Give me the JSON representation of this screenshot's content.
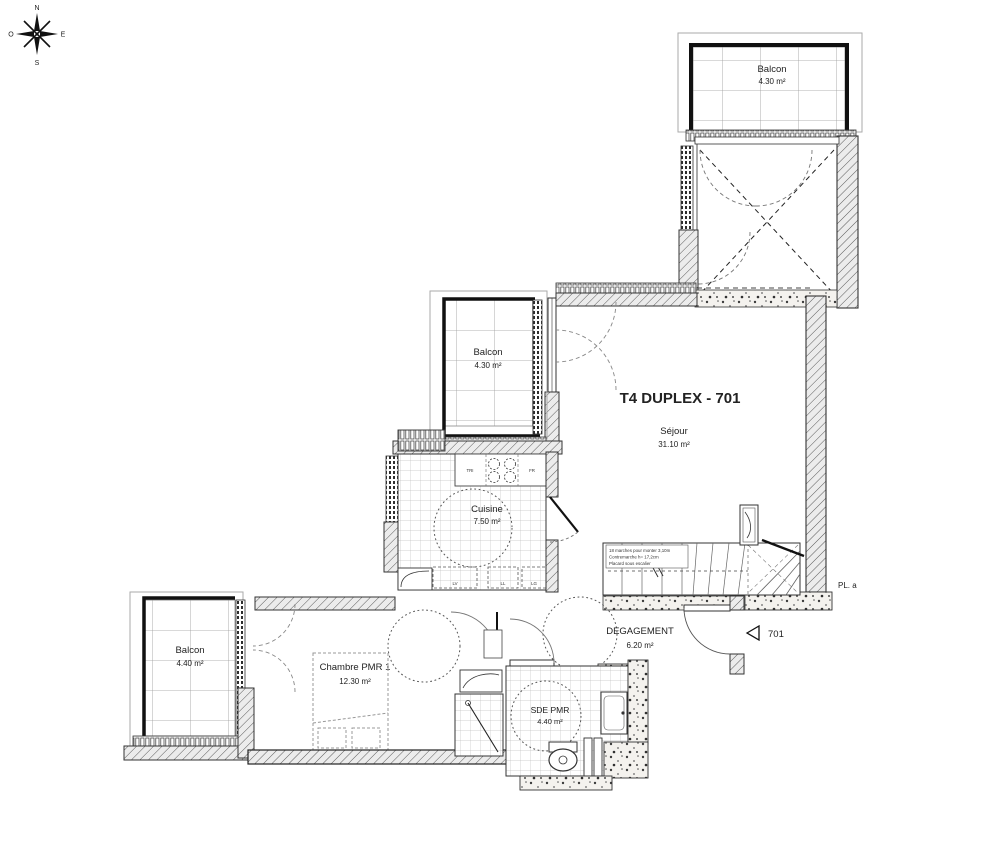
{
  "plan": {
    "title": "T4 DUPLEX - 701",
    "unit_marker": "701",
    "closet_note": "PL. a",
    "compass": {
      "north": "N",
      "east": "E",
      "south": "S",
      "west": "O"
    },
    "rooms": {
      "balcon_top": {
        "name": "Balcon",
        "area": "4.30 m²"
      },
      "sejour": {
        "name": "Séjour",
        "area": "31.10 m²"
      },
      "balcon_mid": {
        "name": "Balcon",
        "area": "4.30 m²"
      },
      "cuisine": {
        "name": "Cuisine",
        "area": "7.50 m²"
      },
      "degagement": {
        "name": "DEGAGEMENT",
        "area": "6.20 m²"
      },
      "balcon_left": {
        "name": "Balcon",
        "area": "4.40 m²"
      },
      "chambre": {
        "name": "Chambre PMR 1",
        "area": "12.30 m²"
      },
      "sde": {
        "name": "SDE PMR",
        "area": "4.40 m²"
      }
    },
    "stair_note": {
      "line1": "18 marches pour monter 3,10m",
      "line2": "Contremarche h= 17,2cm",
      "line3": "Placard sous escalier"
    },
    "kitchen_labels": {
      "tri": "TRI",
      "fr": "FR",
      "lv": "LV",
      "ll": "LL",
      "lg": "LG"
    }
  }
}
